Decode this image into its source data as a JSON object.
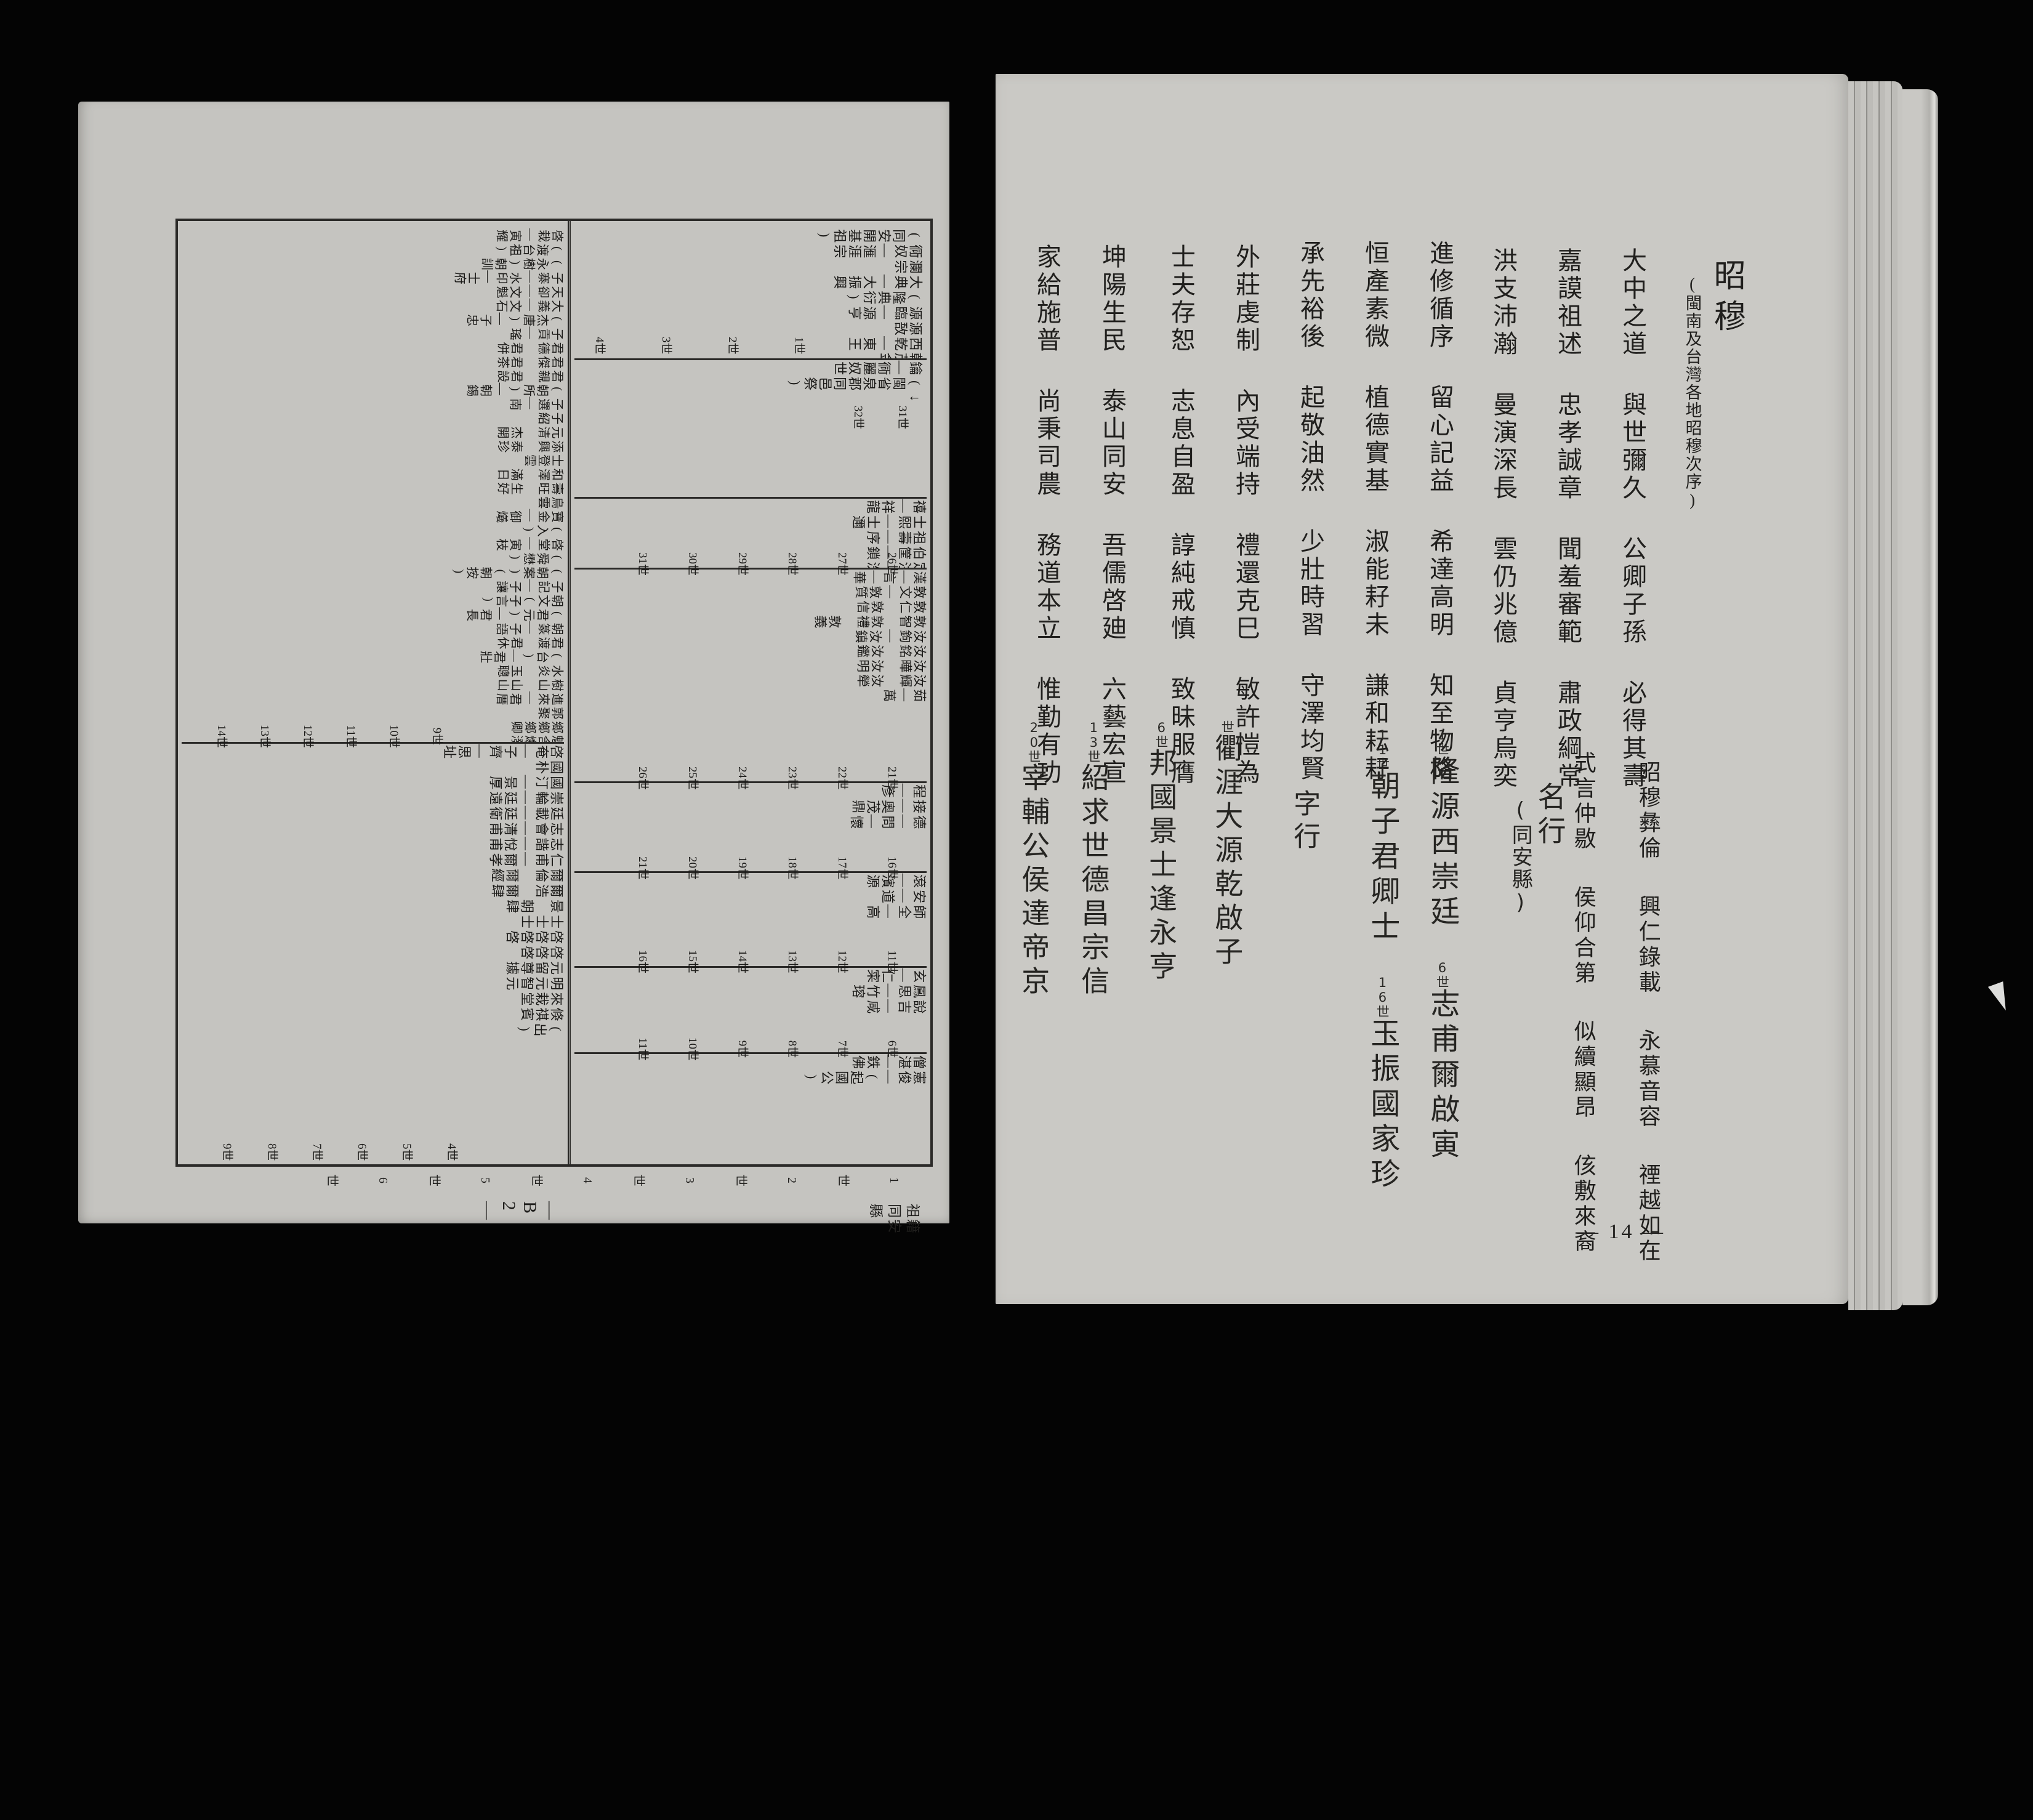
{
  "palette": {
    "background": "#040404",
    "paper_left": "#c5c4c0",
    "paper_right": "#cac9c5",
    "ink": "#201f1d"
  },
  "right_page": {
    "title": {
      "main": "昭穆",
      "note": "(閩南及台灣各地昭穆次序)"
    },
    "shomoku": {
      "cols": [
        [
          "大中之道",
          "與世彌久",
          "公卿子孫",
          "必得其壽"
        ],
        [
          "嘉謨祖述",
          "忠孝誠章",
          "聞羞審範",
          "肅政綱常"
        ],
        [
          "洪支沛瀚",
          "曼演深長",
          "雲仍兆億",
          "貞亨烏奕"
        ],
        [
          "進修循序",
          "留心記益",
          "希達高明",
          "知至物格"
        ],
        [
          "恒產素微",
          "植德實基",
          "淑能耔未",
          "謙和耘耔"
        ],
        [
          "承先裕後",
          "起敬油然",
          "少壯時習",
          "守澤均賢"
        ],
        [
          "外莊虔制",
          "內受端持",
          "禮還克巳",
          "敏許愷為"
        ],
        [
          "士夫存恕",
          "志息自盈",
          "諄純戒慎",
          "致昧服膺"
        ],
        [
          "坤陽生民",
          "泰山同安",
          "吾儒啓廸",
          "六藝宏宣"
        ],
        [
          "家給施普",
          "尚秉司農",
          "務道本立",
          "惟勤有功"
        ]
      ]
    },
    "section2": {
      "printed": [
        [
          "昭穆彝倫",
          "興仁錄載",
          "永慕音容",
          "禋越如在"
        ],
        [
          "式言仲敭",
          "侯仰合第",
          "似續顯昂",
          "侅敷來裔"
        ]
      ],
      "ming": {
        "label": "名行",
        "note": "(同安縣)",
        "cols": [
          {
            "mark": "1世",
            "text": "隆源西崇廷"
          },
          {
            "mark": "6世",
            "text": "志甫爾啟寅"
          },
          {
            "mark": "11世",
            "text": "朝子君卿士"
          },
          {
            "mark": "16世",
            "text": "玉振國家珍"
          }
        ]
      },
      "zi": {
        "label": "字行",
        "cols": [
          {
            "mark": "世",
            "text": "衢涯大源乾啟子"
          },
          {
            "mark": "6世",
            "text": "邦國景士逢永亨"
          },
          {
            "mark": "13世",
            "text": "紹求世德昌宗信"
          },
          {
            "mark": "20世",
            "text": "宰輔公侯達帝京"
          }
        ]
      }
    },
    "page_number": "— 14 —"
  },
  "left_page": {
    "caption": "祖籍同安縣",
    "page_number": "— B 2 —",
    "chart": {
      "panels": {
        "p1": {
          "items": [
            "(同安開基祖)",
            "衕奴—滙涯宗",
            "瀾宗",
            "大典—大振興",
            "(隆典衍)",
            "源臨—源亨",
            "源敔",
            "西乾—東王",
            "乾茂金"
          ],
          "gens": [
            "1世",
            "2世",
            "3世",
            "4世"
          ]
        },
        "p2": {
          "items": [
            "鑰—衕麗奴世",
            "(閩省泉郡同邑祭)",
            "↓"
          ],
          "gens": [
            "31世",
            "32世"
          ]
        },
        "p3": {
          "items": [
            "禧—祥龍",
            "士熙—士邇",
            "祖壽—序",
            "伯筐—鎖",
            "定注—洗"
          ],
          "gens": [
            "26世",
            "27世",
            "28世",
            "29世",
            "30世",
            "31世"
          ]
        },
        "p4": {
          "items": [
            "漢—言—華",
            "敦文—敦質",
            "敦仁　敦信",
            "敦智　敦禮　敦義",
            "汝鉤—汝鎮",
            "汝銘　汝鑑",
            "汝曄　汝明",
            "汝輝　汝犖",
            "茹—萬"
          ],
          "gens": [
            "21世",
            "22世",
            "23世",
            "24世",
            "25世",
            "26世"
          ]
        },
        "p5": {
          "items": [
            "程—彥",
            "接—奧茂鼎",
            "德—問—懷"
          ],
          "gens": [
            "16世",
            "17世",
            "18世",
            "19世",
            "20世",
            "21世"
          ]
        },
        "p6": {
          "items": [
            "滾—濱源",
            "安—道",
            "師全—高"
          ],
          "gens": [
            "11世",
            "12世",
            "13世",
            "14世",
            "15世",
            "16世"
          ]
        },
        "p7": {
          "items": [
            "玄—仁寀",
            "鳳思—竹瑢",
            "說吉—咸"
          ],
          "gens": [
            "6世",
            "7世",
            "8世",
            "9世",
            "10世",
            "11世"
          ]
        },
        "p8": {
          "items": [
            "僧湛—鉄佛",
            "憲俊—(起國公)"
          ],
          "gens": [
            "1世",
            "2世",
            "3世",
            "4世",
            "5世",
            "6世"
          ]
        },
        "lb1": {
          "items": [
            "啓栽—寅耀",
            "(渡台祖)",
            "(永樹)朝訓",
            "子寨—水印—士府",
            "天卻—文魁",
            "大義—文石",
            "(杰唐)—子忠",
            "子貢—瑤",
            "君德　君併",
            "君傑　君茶",
            "君親　君設",
            "(朝所)—朝錫",
            "子選—南",
            "子紹",
            "元清　杰開",
            "添興　泰珍",
            "士登雲",
            "和澤　滿日",
            "壽旺　生好",
            "烏雲",
            "寶金—御爔",
            "(入)",
            "啓堂—寅枝",
            "(舜懋)",
            "(朝案)(朝按)",
            "子記—子讓",
            "朝文(子言)",
            "(君元)—君長",
            "朝篆—子語",
            "君渡　君休",
            "(台)—君壯",
            "水炎　玉聰",
            "樹山　山山",
            "進來—君厝",
            "郭聚",
            "鄉鄉鄉卿",
            "魁含爔潑",
            "(出)"
          ],
          "gens": [
            "9世",
            "10世",
            "11世",
            "12世",
            "13世",
            "14世"
          ]
        },
        "lb2": {
          "items": [
            "啓奄—子齊—思址",
            "國朴",
            "國汀—景厚",
            "崇輪—廷遠",
            "廷載—廷衛",
            "志會—清甫",
            "志諧—悅甫",
            "仁甫—爾孝",
            "爾倫　爾經",
            "爾浩　爾肆",
            "景　朝肆",
            "士士士",
            "啓啓啓啓",
            "啓啓啓",
            "元留尊據",
            "明元智元",
            "來栽堂",
            "倏祺賓",
            "(出)"
          ],
          "gens": [
            "4世",
            "5世",
            "6世",
            "7世",
            "8世",
            "9世"
          ]
        }
      }
    }
  }
}
